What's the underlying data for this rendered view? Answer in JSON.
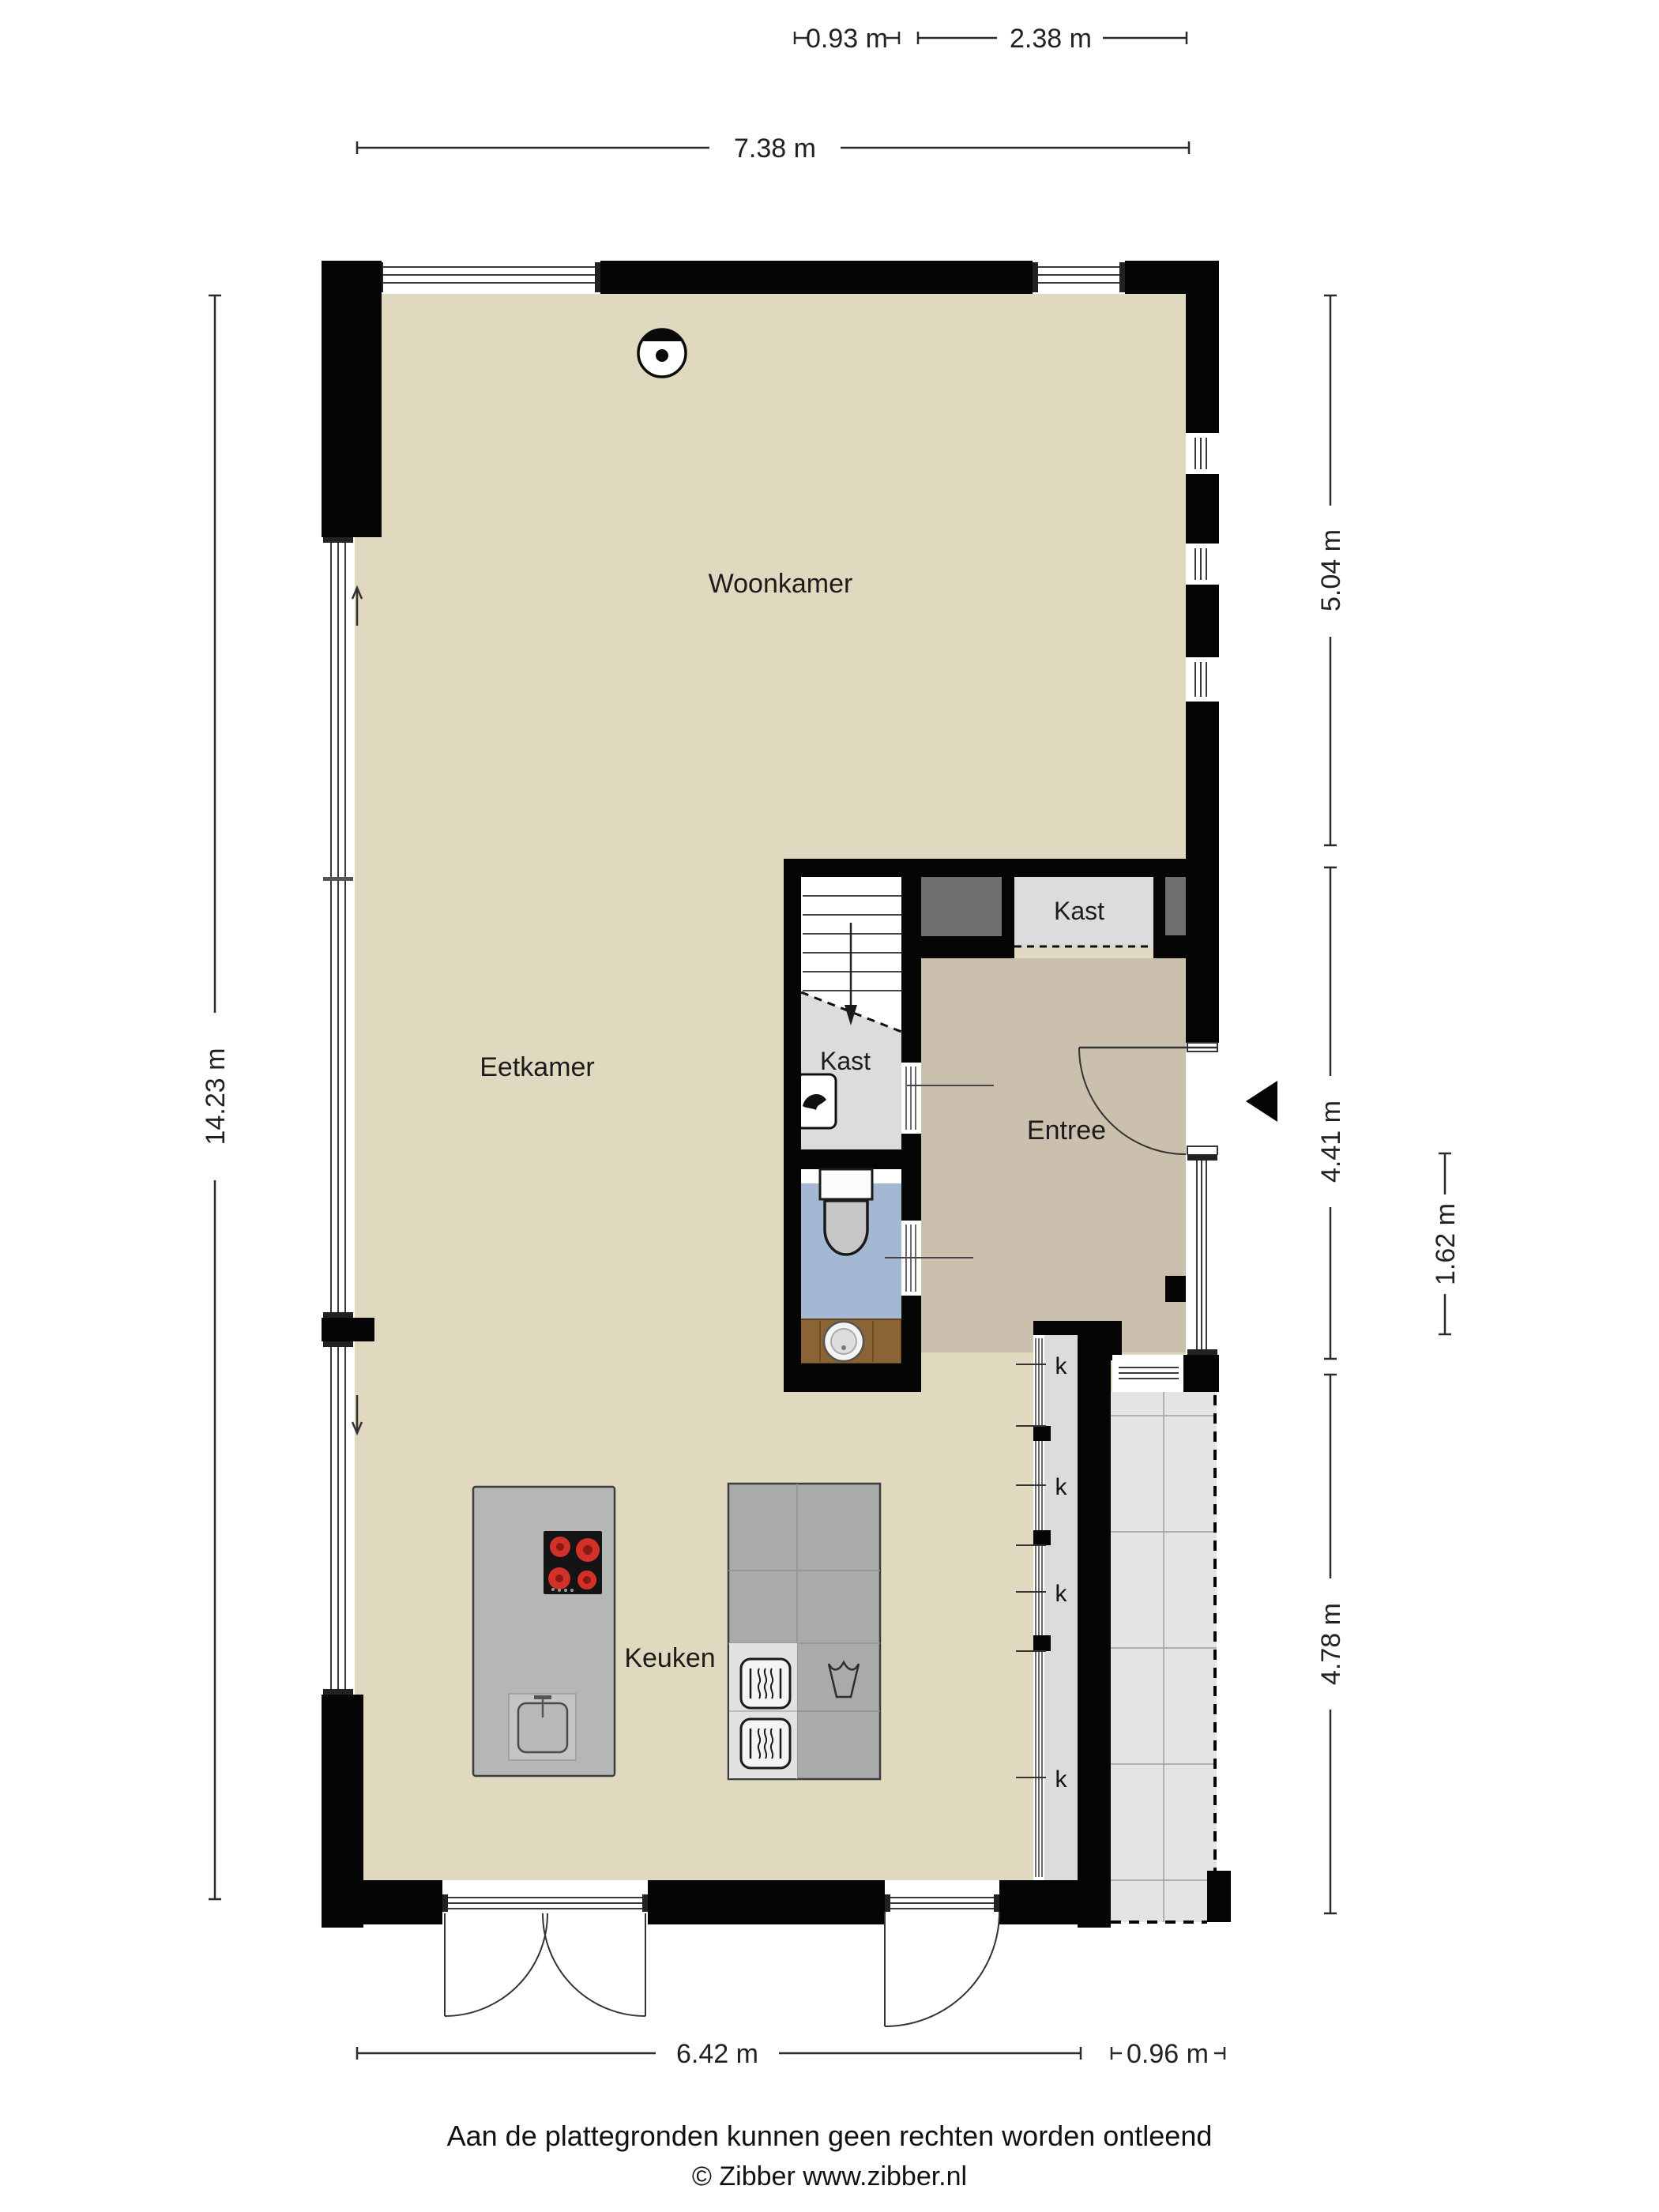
{
  "rooms": {
    "living": "Woonkamer",
    "dining": "Eetkamer",
    "kitchen": "Keuken",
    "entry": "Entree",
    "closet_hall": "Kast",
    "closet_stairs": "Kast",
    "closet_marks": [
      "k",
      "k",
      "k",
      "k"
    ]
  },
  "dimensions": {
    "top_left_width": "0.93 m",
    "top_right_width": "2.38 m",
    "top_total_width": "7.38 m",
    "left_height": "14.23 m",
    "right_upper_height": "5.04 m",
    "right_middle_height": "4.41 m",
    "right_inner_height": "1.62 m",
    "right_lower_height": "4.78 m",
    "bottom_main_width": "6.42 m",
    "bottom_extension_width": "0.96 m"
  },
  "footer": {
    "disclaimer": "Aan de plattegronden kunnen geen rechten worden ontleend",
    "copyright": "© Zibber www.zibber.nl"
  },
  "icons": {
    "ceiling_light": "ceiling-light-icon",
    "entrance_arrow": "entrance-arrow-icon",
    "stairs_arrow": "stairs-direction-arrow-icon",
    "sliding_door_arrows": "sliding-direction-arrow-icon",
    "toilet": "toilet-icon",
    "washbasin": "washbasin-icon",
    "cooktop": "cooktop-icon",
    "oven": "oven-icon",
    "boiler": "boiler-icon"
  },
  "colors": {
    "floor_main": "#e0d9c0",
    "floor_entry": "#cbbfae",
    "floor_closet": "#dcdcdc",
    "floor_toilet": "#a4b8d4",
    "vanity_wood": "#8a6434",
    "wall": "#050505",
    "kitchen_unit": "#b4b7b6",
    "counter": "#a8abaa",
    "burner_red": "#d23129",
    "tiles_outside": "#e4e4e4"
  }
}
